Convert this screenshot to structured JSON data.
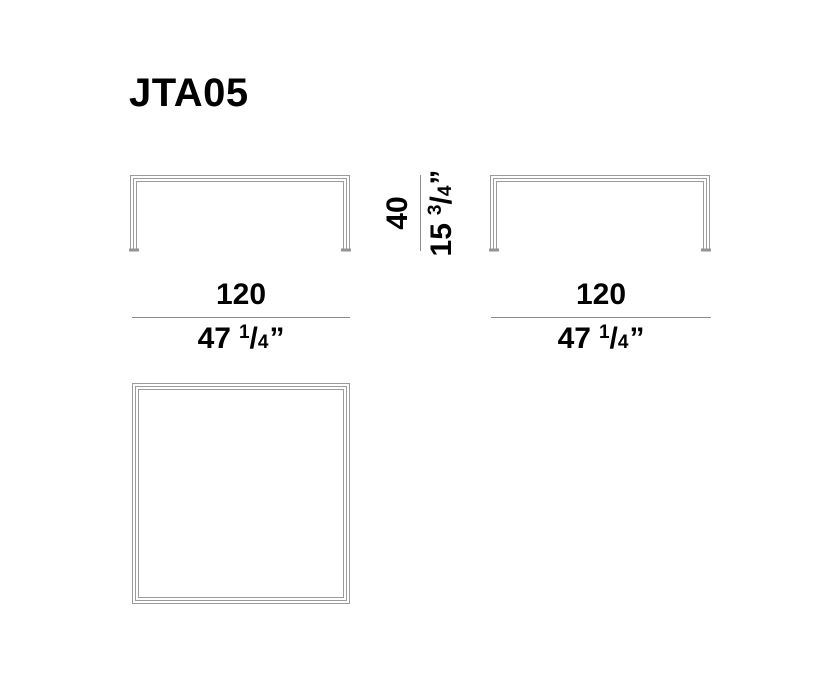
{
  "colors": {
    "background": "#ffffff",
    "text": "#000000",
    "drawing_line": "#9b9b9b",
    "dimension_rule": "#8c8c8c",
    "foot_cap": "#949494"
  },
  "header": {
    "title": "JTA05"
  },
  "views": {
    "front_elevation": {
      "width": {
        "metric": "120",
        "imperial_whole": "47",
        "frac_numerator": "1",
        "frac_slash": "/",
        "frac_denominator": "4",
        "unit_mark": "”"
      }
    },
    "side_elevation": {
      "width": {
        "metric": "120",
        "imperial_whole": "47",
        "frac_numerator": "1",
        "frac_slash": "/",
        "frac_denominator": "4",
        "unit_mark": "”"
      }
    },
    "height": {
      "metric": "40",
      "imperial_whole": "15",
      "frac_numerator": "3",
      "frac_slash": "/",
      "frac_denominator": "4",
      "unit_mark": "”"
    }
  }
}
